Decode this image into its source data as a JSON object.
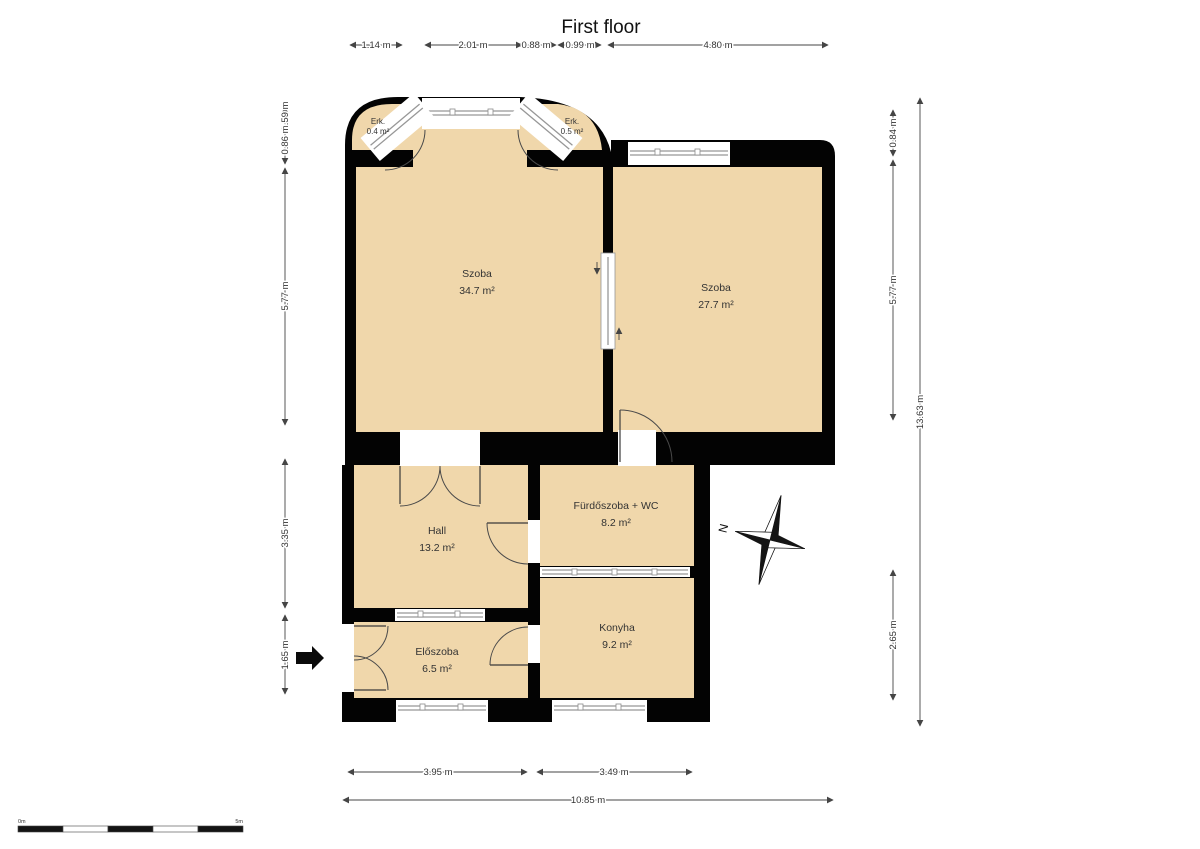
{
  "title": "First floor",
  "rooms": {
    "szoba1": {
      "name": "Szoba",
      "area": "34.7 m²"
    },
    "szoba2": {
      "name": "Szoba",
      "area": "27.7 m²"
    },
    "hall": {
      "name": "Hall",
      "area": "13.2 m²"
    },
    "bathroom": {
      "name": "Fürdőszoba + WC",
      "area": "8.2 m²"
    },
    "kitchen": {
      "name": "Konyha",
      "area": "9.2 m²"
    },
    "entry": {
      "name": "Előszoba",
      "area": "6.5 m²"
    },
    "balcony1": {
      "name": "Erk.",
      "area": "0.4 m²"
    },
    "balcony2": {
      "name": "Erk.",
      "area": "0.5 m²"
    }
  },
  "dimensions": {
    "top": {
      "d1": "1.14 m",
      "d2": "2.01 m",
      "d3": "0.88 m",
      "d4": "0.99 m",
      "d5": "4.80 m"
    },
    "left": {
      "d1": "0.59 m",
      "d2": "0.86 m",
      "d3": "5.77 m",
      "d4": "3.35 m",
      "d5": "1.65 m"
    },
    "right": {
      "d1": "0.84 m",
      "d2": "5.77 m",
      "d3": "2.65 m",
      "total": "13.63 m"
    },
    "bottom": {
      "d1": "3.95 m",
      "d2": "3.49 m",
      "total": "10.85 m"
    }
  },
  "compass": {
    "north_label": "N"
  },
  "scale_bar": {
    "start_label": "0m",
    "end_label": "5m"
  },
  "colors": {
    "room_fill": "#f0d7ab",
    "wall": "#030303",
    "window": "#979797",
    "dimension": "#454545"
  }
}
